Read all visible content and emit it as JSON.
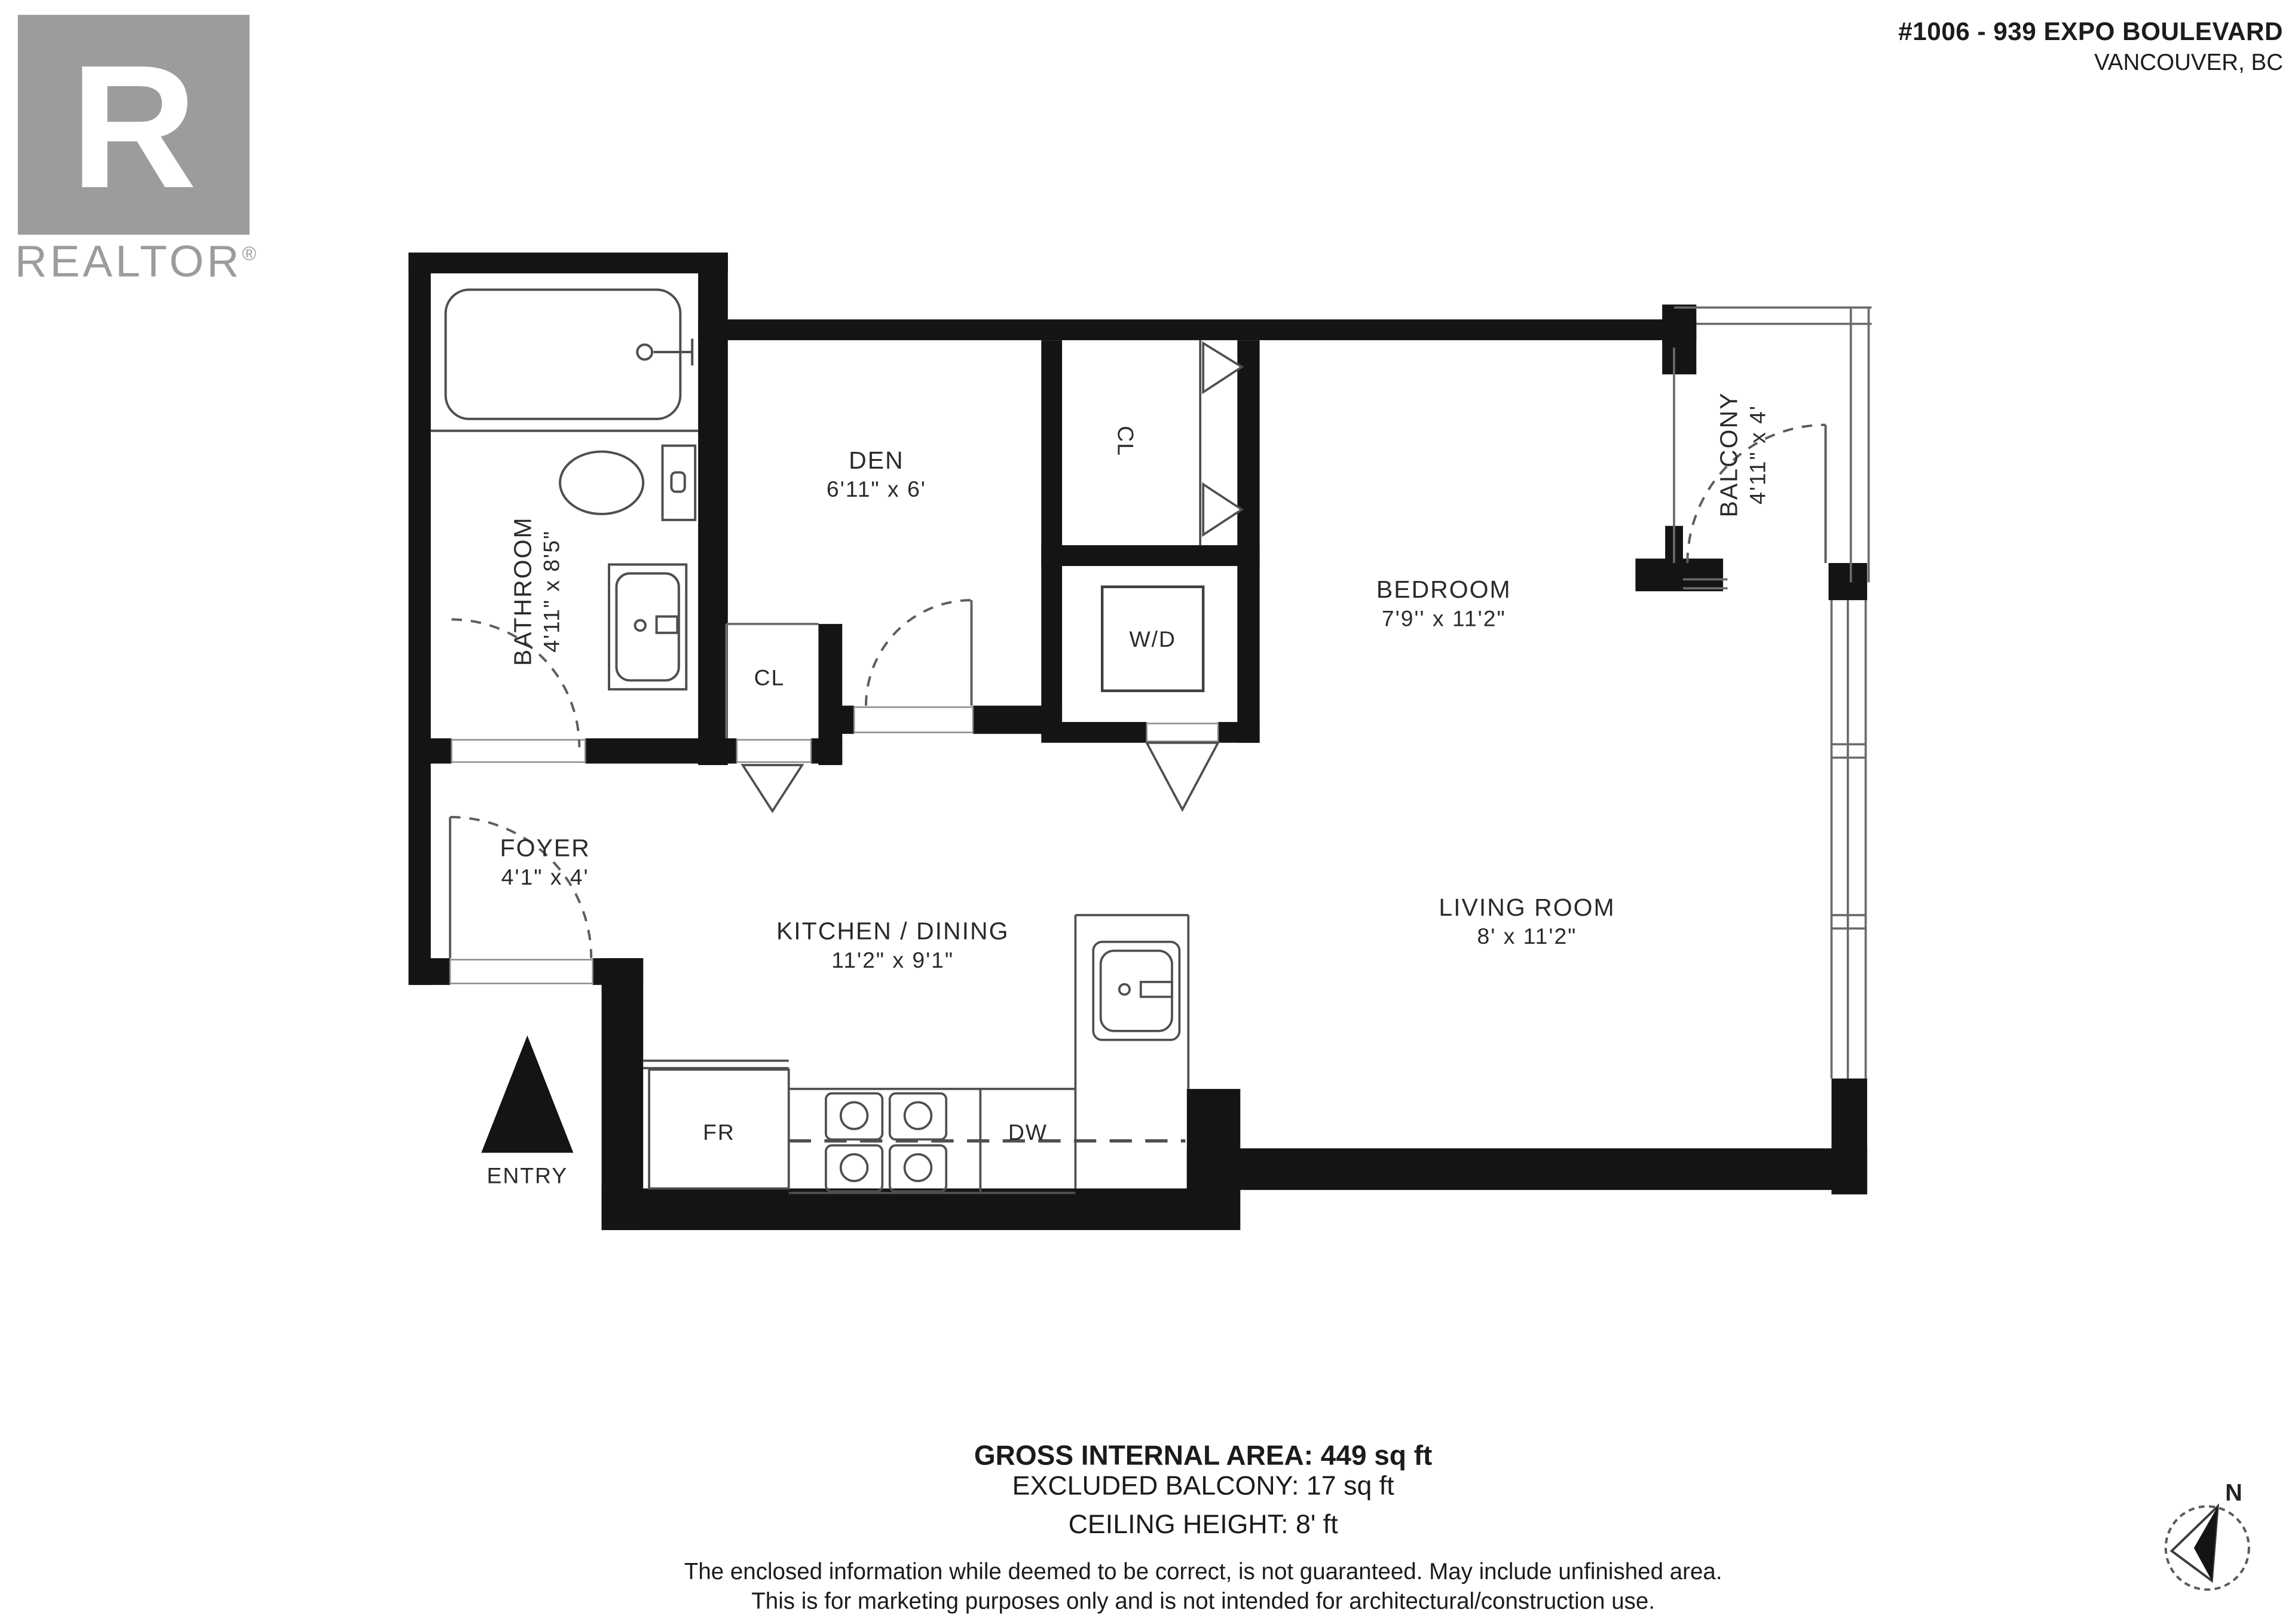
{
  "header": {
    "logo": {
      "letter": "R",
      "brand": "REALTOR",
      "registered": "®"
    },
    "address_line1": "#1006 - 939 EXPO BOULEVARD",
    "address_line2": "VANCOUVER, BC"
  },
  "rooms": [
    {
      "name": "BATHROOM",
      "dims": "4'11\" x 8'5\""
    },
    {
      "name": "DEN",
      "dims": "6'11\" x 6'"
    },
    {
      "name": "CL"
    },
    {
      "name": "W/D"
    },
    {
      "name": "BEDROOM",
      "dims": "7'9'' x 11'2\""
    },
    {
      "name": "BALCONY",
      "dims": "4'11\" x 4'"
    },
    {
      "name": "FOYER",
      "dims": "4'1\" x 4'"
    },
    {
      "name": "KITCHEN / DINING",
      "dims": "11'2\" x 9'1\""
    },
    {
      "name": "LIVING ROOM",
      "dims": "8' x 11'2\""
    },
    {
      "name": "CL"
    },
    {
      "name": "FR"
    },
    {
      "name": "DW"
    },
    {
      "name": "ENTRY"
    }
  ],
  "footer": {
    "gross_area": "GROSS INTERNAL AREA: 449 sq ft",
    "excluded_balcony": "EXCLUDED BALCONY: 17 sq ft",
    "ceiling_height": "CEILING HEIGHT: 8' ft",
    "disclaimer1": "The enclosed information while deemed to be correct, is not guaranteed. May include unfinished area.",
    "disclaimer2": "This is for marketing purposes only and is not intended for architectural/construction use."
  },
  "compass": {
    "label": "N"
  },
  "colors": {
    "wall": "#141414",
    "line": "#6b6b6b",
    "logo_gray": "#9c9c9c",
    "text": "#1b1b1b"
  }
}
